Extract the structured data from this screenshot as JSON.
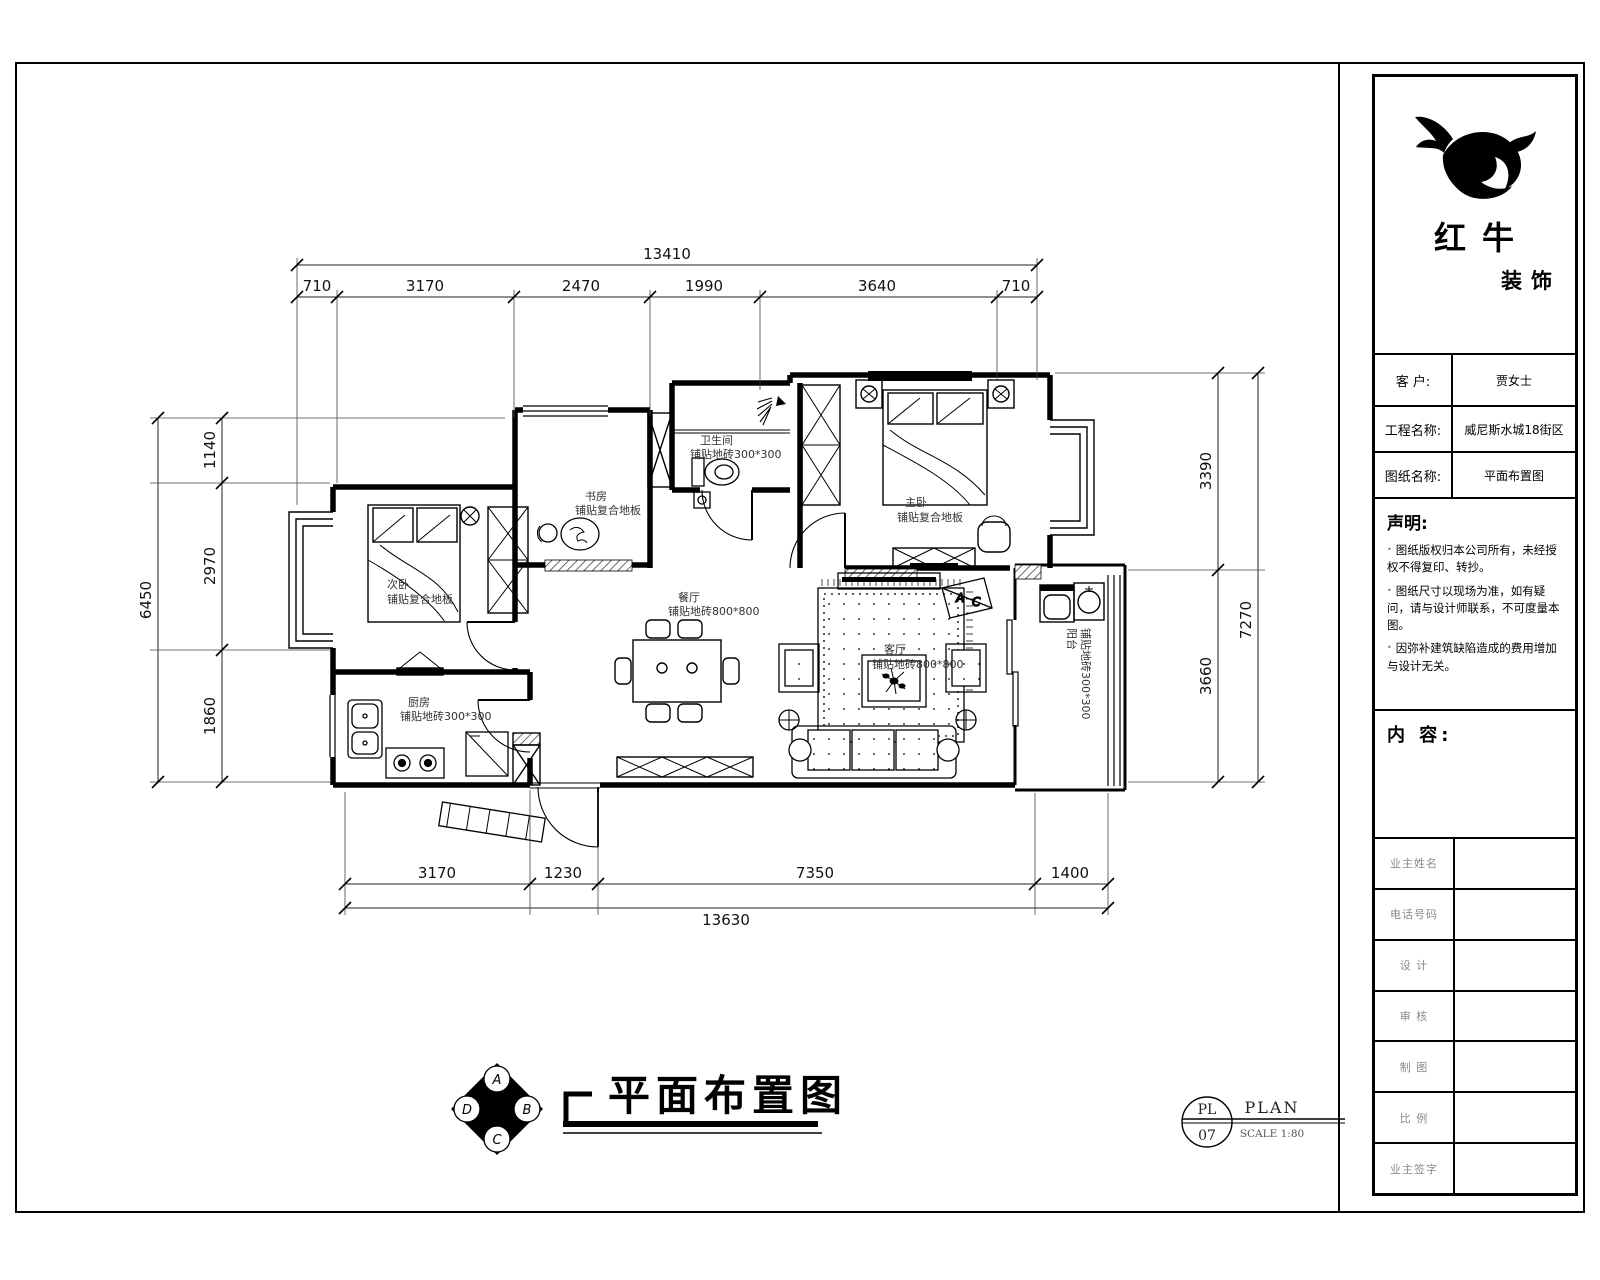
{
  "title_block": {
    "logo": {
      "name": "红牛",
      "sub": "装饰"
    },
    "fields": [
      {
        "label": "客  户:",
        "value": "贾女士"
      },
      {
        "label": "工程名称:",
        "value": "威尼斯水城18街区"
      },
      {
        "label": "图纸名称:",
        "value": "平面布置图"
      }
    ],
    "statement": {
      "title": "声明:",
      "items": [
        "图纸版权归本公司所有，未经授权不得复印、转抄。",
        "图纸尺寸以现场为准，如有疑问，请与设计师联系，不可度量本图。",
        "因弥补建筑缺陷造成的费用增加与设计无关。"
      ]
    },
    "content_label": "内 容:",
    "sign_rows": [
      "业主姓名",
      "电话号码",
      "设 计",
      "审 核",
      "制 图",
      "比 例",
      "业主签字"
    ]
  },
  "dims": {
    "top": {
      "total": "13410",
      "segs": [
        "710",
        "3170",
        "2470",
        "1990",
        "3640",
        "710"
      ]
    },
    "bottom": {
      "total": "13630",
      "segs": [
        "3170",
        "1230",
        "7350",
        "1400"
      ]
    },
    "left": {
      "total": "6450",
      "segs": [
        "1140",
        "2970",
        "1860"
      ]
    },
    "right": {
      "total": "7270",
      "segs": [
        "3390",
        "3660"
      ]
    }
  },
  "rooms": [
    {
      "name": "次卧",
      "finish": "铺贴复合地板"
    },
    {
      "name": "书房",
      "finish": "铺贴复合地板"
    },
    {
      "name": "卫生间",
      "finish": "铺贴地砖300*300"
    },
    {
      "name": "主卧",
      "finish": "铺贴复合地板"
    },
    {
      "name": "厨房",
      "finish": "铺贴地砖300*300"
    },
    {
      "name": "餐厅",
      "finish": "铺贴地砖800*800"
    },
    {
      "name": "客厅",
      "finish": "铺贴地砖800*800"
    },
    {
      "name": "阳台",
      "finish": "铺贴地砖300*300"
    }
  ],
  "ac_marker": {
    "a": "A",
    "c": "C"
  },
  "footer": {
    "title": "平面布置图",
    "compass": {
      "n": "A",
      "e": "B",
      "s": "C",
      "w": "D"
    },
    "ref": {
      "code": "PL",
      "num": "07",
      "label": "PLAN",
      "scale": "SCALE 1:80"
    }
  }
}
